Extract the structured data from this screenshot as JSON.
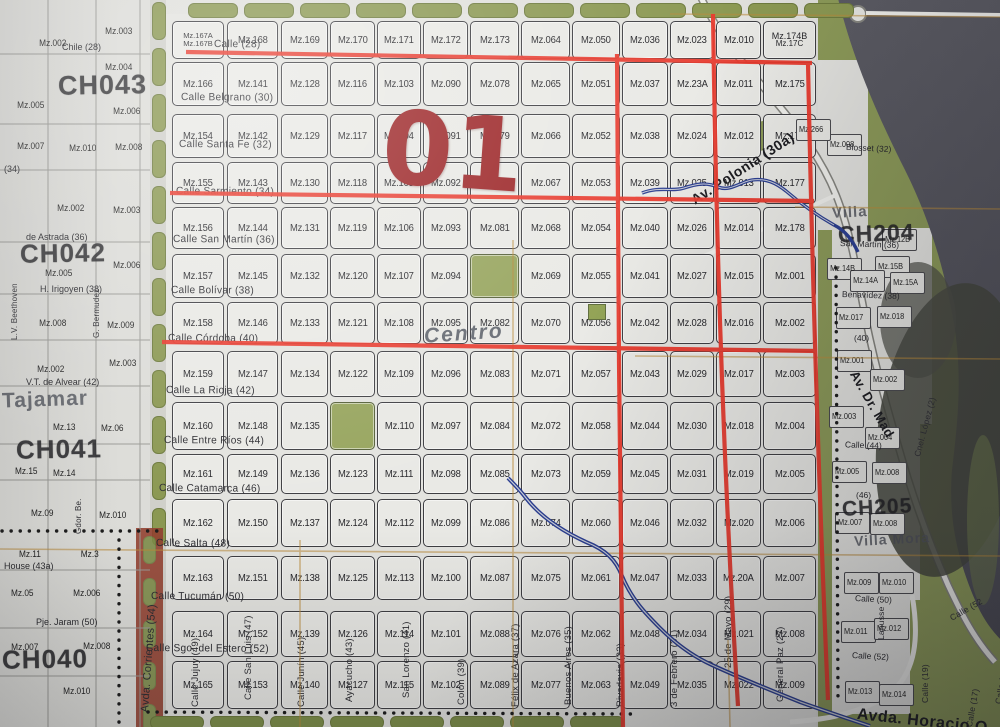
{
  "overlay": {
    "district_number": "01",
    "center_note": "Centro"
  },
  "grid": {
    "block_rows": [
      [
        "Mz.167A",
        "Mz.168",
        "Mz.169",
        "Mz.170",
        "Mz.171",
        "Mz.172",
        "Mz.173",
        "Mz.064",
        "Mz.050",
        "Mz.036",
        "Mz.023",
        "Mz.010",
        "Mz.174B"
      ],
      [
        "Mz.166",
        "Mz.141",
        "Mz.128",
        "Mz.116",
        "Mz.103",
        "Mz.090",
        "Mz.078",
        "Mz.065",
        "Mz.051",
        "Mz.037",
        "Mz.23A",
        "Mz.011",
        "Mz.175"
      ],
      [
        "Mz.154",
        "Mz.142",
        "Mz.129",
        "Mz.117",
        "Mz.104",
        "Mz.091",
        "Mz.079",
        "Mz.066",
        "Mz.052",
        "Mz.038",
        "Mz.024",
        "Mz.012",
        "Mz.176"
      ],
      [
        "Mz.155",
        "Mz.143",
        "Mz.130",
        "Mz.118",
        "Mz.105",
        "Mz.092",
        "Mz.080",
        "Mz.067",
        "Mz.053",
        "Mz.039",
        "Mz.025",
        "Mz.013",
        "Mz.177"
      ],
      [
        "Mz.156",
        "Mz.144",
        "Mz.131",
        "Mz.119",
        "Mz.106",
        "Mz.093",
        "Mz.081",
        "Mz.068",
        "Mz.054",
        "Mz.040",
        "Mz.026",
        "Mz.014",
        "Mz.178"
      ],
      [
        "Mz.157",
        "Mz.145",
        "Mz.132",
        "Mz.120",
        "Mz.107",
        "Mz.094",
        "",
        "Mz.069",
        "Mz.055",
        "Mz.041",
        "Mz.027",
        "Mz.015",
        "Mz.001"
      ],
      [
        "Mz.158",
        "Mz.146",
        "Mz.133",
        "Mz.121",
        "Mz.108",
        "Mz.095",
        "Mz.082",
        "Mz.070",
        "Mz.056",
        "Mz.042",
        "Mz.028",
        "Mz.016",
        "Mz.002"
      ],
      [
        "Mz.159",
        "Mz.147",
        "Mz.134",
        "Mz.122",
        "Mz.109",
        "Mz.096",
        "Mz.083",
        "Mz.071",
        "Mz.057",
        "Mz.043",
        "Mz.029",
        "Mz.017",
        "Mz.003"
      ],
      [
        "Mz.160",
        "Mz.148",
        "Mz.135",
        "",
        "Mz.110",
        "Mz.097",
        "Mz.084",
        "Mz.072",
        "Mz.058",
        "Mz.044",
        "Mz.030",
        "Mz.018",
        "Mz.004"
      ],
      [
        "Mz.161",
        "Mz.149",
        "Mz.136",
        "Mz.123",
        "Mz.111",
        "Mz.098",
        "Mz.085",
        "Mz.073",
        "Mz.059",
        "Mz.045",
        "Mz.031",
        "Mz.019",
        "Mz.005"
      ],
      [
        "Mz.162",
        "Mz.150",
        "Mz.137",
        "Mz.124",
        "Mz.112",
        "Mz.099",
        "Mz.086",
        "Mz.074",
        "Mz.060",
        "Mz.046",
        "Mz.032",
        "Mz.020",
        "Mz.006"
      ],
      [
        "Mz.163",
        "Mz.151",
        "Mz.138",
        "Mz.125",
        "Mz.113",
        "Mz.100",
        "Mz.087",
        "Mz.075",
        "Mz.061",
        "Mz.047",
        "Mz.033",
        "Mz.20A",
        "Mz.007"
      ],
      [
        "Mz.164",
        "Mz.152",
        "Mz.139",
        "Mz.126",
        "Mz.114",
        "Mz.101",
        "Mz.088",
        "Mz.076",
        "Mz.062",
        "Mz.048",
        "Mz.034",
        "Mz.021",
        "Mz.008"
      ],
      [
        "Mz.165",
        "Mz.153",
        "Mz.140",
        "Mz.127",
        "Mz.115",
        "Mz.102",
        "Mz.089",
        "Mz.077",
        "Mz.063",
        "Mz.049",
        "Mz.035",
        "Mz.022",
        "Mz.009"
      ]
    ],
    "corner_sublabels": {
      "row1_col1_b": "Mz.167B",
      "row1_col13_b": "Mz.17C"
    },
    "green_cells": [
      [
        6,
        7
      ],
      [
        9,
        4
      ]
    ]
  },
  "streets_horizontal": [
    {
      "label": "Calle (28)",
      "x": 214,
      "y": 44
    },
    {
      "label": "Calle Belgrano (30)",
      "x": 181,
      "y": 97
    },
    {
      "label": "Calle Santa Fe (32)",
      "x": 179,
      "y": 144
    },
    {
      "label": "Calle Sarmiento (34)",
      "x": 176,
      "y": 191
    },
    {
      "label": "Calle San Martín (36)",
      "x": 173,
      "y": 239
    },
    {
      "label": "Calle Bolívar (38)",
      "x": 171,
      "y": 290
    },
    {
      "label": "Calle Córdoba (40)",
      "x": 168,
      "y": 338
    },
    {
      "label": "Calle La Rioja (42)",
      "x": 166,
      "y": 390
    },
    {
      "label": "Calle Entre Ríos (44)",
      "x": 164,
      "y": 440
    },
    {
      "label": "Calle Catamarca (46)",
      "x": 159,
      "y": 488
    },
    {
      "label": "Calle Salta (48)",
      "x": 156,
      "y": 543
    },
    {
      "label": "Calle Tucumán (50)",
      "x": 151,
      "y": 596
    },
    {
      "label": "Calle Sgo. del Estero (52)",
      "x": 146,
      "y": 648
    }
  ],
  "streets_vertical": [
    {
      "label": "Avda. Corrientes (54)",
      "x": 139,
      "y": 712,
      "size": 11,
      "rot": -86
    },
    {
      "label": "Calle Jujuy (49)",
      "x": 190,
      "y": 707
    },
    {
      "label": "Calle San Luis (47)",
      "x": 243,
      "y": 700
    },
    {
      "label": "Calle Junín (45)",
      "x": 296,
      "y": 707
    },
    {
      "label": "Ayacucho (43)",
      "x": 344,
      "y": 702
    },
    {
      "label": "San Lorenzo (41)",
      "x": 401,
      "y": 698
    },
    {
      "label": "Colón (39)",
      "x": 456,
      "y": 705
    },
    {
      "label": "Félix de Azara (37)",
      "x": 510,
      "y": 707
    },
    {
      "label": "Buenos Aires (35)",
      "x": 563,
      "y": 705
    },
    {
      "label": "Rivadavia (33)",
      "x": 615,
      "y": 707
    },
    {
      "label": "3 de Febrero (31)",
      "x": 669,
      "y": 707
    },
    {
      "label": "25 de Mayo (29)",
      "x": 723,
      "y": 668
    },
    {
      "label": "General Paz (27)",
      "x": 775,
      "y": 702
    }
  ],
  "zone_labels": [
    {
      "label": "CH043",
      "x": 58,
      "y": 70,
      "size": 27,
      "rot": -1,
      "gray": false
    },
    {
      "label": "CH042",
      "x": 20,
      "y": 238,
      "size": 26,
      "rot": -1,
      "gray": false
    },
    {
      "label": "Tajamar",
      "x": 2,
      "y": 388,
      "size": 21,
      "rot": -2,
      "gray": true
    },
    {
      "label": "CH041",
      "x": 16,
      "y": 434,
      "size": 26,
      "rot": -1,
      "gray": false
    },
    {
      "label": "CH040",
      "x": 2,
      "y": 644,
      "size": 26,
      "rot": -1,
      "gray": false
    },
    {
      "label": "Villa",
      "x": 832,
      "y": 204,
      "size": 15,
      "rot": -3,
      "gray": true
    },
    {
      "label": "CH204",
      "x": 838,
      "y": 220,
      "size": 23,
      "rot": -2,
      "gray": false
    },
    {
      "label": "CH205",
      "x": 842,
      "y": 496,
      "size": 21,
      "rot": -3,
      "gray": false
    },
    {
      "label": "Villa Mora",
      "x": 854,
      "y": 531,
      "size": 14,
      "rot": -3,
      "gray": true
    }
  ],
  "left_zone": {
    "blocks": [
      {
        "label": "Mz.002",
        "x": 38,
        "y": 38
      },
      {
        "label": "Mz.003",
        "x": 104,
        "y": 26
      },
      {
        "label": "Mz.004",
        "x": 104,
        "y": 62
      },
      {
        "label": "Mz.005",
        "x": 16,
        "y": 100
      },
      {
        "label": "Mz.006",
        "x": 112,
        "y": 106
      },
      {
        "label": "Mz.007",
        "x": 16,
        "y": 141
      },
      {
        "label": "Mz.010",
        "x": 68,
        "y": 143
      },
      {
        "label": "Mz.008",
        "x": 114,
        "y": 142
      },
      {
        "label": "Mz.002",
        "x": 56,
        "y": 203
      },
      {
        "label": "Mz.003",
        "x": 112,
        "y": 205
      },
      {
        "label": "Mz.005",
        "x": 44,
        "y": 268
      },
      {
        "label": "Mz.006",
        "x": 112,
        "y": 260
      },
      {
        "label": "Mz.008",
        "x": 38,
        "y": 318
      },
      {
        "label": "Mz.009",
        "x": 106,
        "y": 320
      },
      {
        "label": "Mz.002",
        "x": 36,
        "y": 364
      },
      {
        "label": "Mz.003",
        "x": 108,
        "y": 358
      },
      {
        "label": "Mz.13",
        "x": 52,
        "y": 422
      },
      {
        "label": "Mz.06",
        "x": 100,
        "y": 423
      },
      {
        "label": "Mz.15",
        "x": 14,
        "y": 466
      },
      {
        "label": "Mz.14",
        "x": 52,
        "y": 468
      },
      {
        "label": "Mz.09",
        "x": 30,
        "y": 508
      },
      {
        "label": "Mz.010",
        "x": 98,
        "y": 510
      },
      {
        "label": "Mz.11",
        "x": 18,
        "y": 549
      },
      {
        "label": "Mz.3",
        "x": 80,
        "y": 549
      },
      {
        "label": "Mz.05",
        "x": 10,
        "y": 588
      },
      {
        "label": "Mz.006",
        "x": 72,
        "y": 588
      },
      {
        "label": "Mz.007",
        "x": 10,
        "y": 642
      },
      {
        "label": "Mz.008",
        "x": 82,
        "y": 641
      },
      {
        "label": "Mz.010",
        "x": 62,
        "y": 686
      }
    ],
    "streets": [
      {
        "label": "Chile (28)",
        "x": 62,
        "y": 42
      },
      {
        "label": "(34)",
        "x": 4,
        "y": 164
      },
      {
        "label": "de Astrada (36)",
        "x": 26,
        "y": 232
      },
      {
        "label": "H. Irigoyen (38)",
        "x": 40,
        "y": 284
      },
      {
        "label": "V.T. de Alvear (42)",
        "x": 26,
        "y": 377
      },
      {
        "label": "House (43a)",
        "x": 4,
        "y": 561
      },
      {
        "label": "Pje. Jaram (50)",
        "x": 36,
        "y": 617
      }
    ],
    "verticals": [
      {
        "label": "L.V. Beethoven",
        "x": 10,
        "y": 340
      },
      {
        "label": "G. Bermudez",
        "x": 92,
        "y": 338
      },
      {
        "label": "Gdor. Be.",
        "x": 74,
        "y": 534
      }
    ]
  },
  "east_zone": {
    "blocks": [
      {
        "label": "Mz.008",
        "x": 843,
        "y": 146
      },
      {
        "label": "Mz.266",
        "x": 812,
        "y": 131
      },
      {
        "label": "Mz.12B",
        "x": 898,
        "y": 241
      },
      {
        "label": "Mz.14B",
        "x": 843,
        "y": 270
      },
      {
        "label": "Mz.15B",
        "x": 891,
        "y": 268
      },
      {
        "label": "Mz.14A",
        "x": 866,
        "y": 282
      },
      {
        "label": "Mz.15A",
        "x": 906,
        "y": 284
      },
      {
        "label": "Mz.017",
        "x": 852,
        "y": 319
      },
      {
        "label": "Mz.018",
        "x": 893,
        "y": 318
      },
      {
        "label": "Mz.001",
        "x": 853,
        "y": 362
      },
      {
        "label": "Mz.002",
        "x": 886,
        "y": 381
      },
      {
        "label": "Mz.003",
        "x": 845,
        "y": 418
      },
      {
        "label": "Mz.004",
        "x": 881,
        "y": 439
      },
      {
        "label": "Mz.005",
        "x": 848,
        "y": 473
      },
      {
        "label": "Mz.008",
        "x": 888,
        "y": 474
      },
      {
        "label": "Mz.007",
        "x": 851,
        "y": 524
      },
      {
        "label": "Mz.008",
        "x": 886,
        "y": 525
      },
      {
        "label": "Mz.009",
        "x": 860,
        "y": 584
      },
      {
        "label": "Mz.010",
        "x": 895,
        "y": 584
      },
      {
        "label": "Mz.011",
        "x": 857,
        "y": 633
      },
      {
        "label": "Mz.012",
        "x": 890,
        "y": 630
      },
      {
        "label": "Mz.013",
        "x": 861,
        "y": 693
      },
      {
        "label": "Mz.014",
        "x": 895,
        "y": 696
      }
    ],
    "streets": [
      {
        "label": "Blosset (32)",
        "x": 846,
        "y": 148,
        "rot": 3
      },
      {
        "label": "San Martín (36)",
        "x": 840,
        "y": 244,
        "rot": 2
      },
      {
        "label": "Benavídez (38)",
        "x": 842,
        "y": 295,
        "rot": 2
      },
      {
        "label": "(40)",
        "x": 854,
        "y": 338,
        "rot": 0
      },
      {
        "label": "Calle (44)",
        "x": 845,
        "y": 445,
        "rot": 2
      },
      {
        "label": "(46)",
        "x": 856,
        "y": 495,
        "rot": 0
      },
      {
        "label": "Calle (50)",
        "x": 855,
        "y": 599,
        "rot": 3
      },
      {
        "label": "Calle (52)",
        "x": 852,
        "y": 656,
        "rot": 3
      }
    ],
    "verticals": [
      {
        "label": "Lanusse",
        "x": 876,
        "y": 640,
        "rot": -90
      },
      {
        "label": "Cnel. López (2)",
        "x": 912,
        "y": 455,
        "rot": -75
      },
      {
        "label": "Calle (19)",
        "x": 920,
        "y": 703,
        "rot": -90
      },
      {
        "label": "Calle (17)",
        "x": 964,
        "y": 726,
        "rot": -80
      },
      {
        "label": "Calle (15)",
        "x": 993,
        "y": 703,
        "rot": -80
      },
      {
        "label": "Calle (52",
        "x": 948,
        "y": 614,
        "rot": -30
      }
    ],
    "diagonals": [
      {
        "label": "Av. Polonia (30a)",
        "x": 688,
        "y": 194,
        "rot": -33,
        "size": 14
      },
      {
        "label": "Av. Dr. Mad",
        "x": 860,
        "y": 368,
        "rot": 60,
        "size": 13
      },
      {
        "label": "Avda. Horacio Q",
        "x": 858,
        "y": 706,
        "rot": 6,
        "size": 16
      }
    ]
  },
  "colors": {
    "red_overlay": "#e8392c",
    "district_red": "#9c2527",
    "paper": "#e3e3df",
    "park_green": "#97a55e",
    "shore_green": "#8c9a58",
    "water": "#56565f",
    "river_blue": "#2b3e91",
    "grid_tan": "#b98a3a"
  }
}
